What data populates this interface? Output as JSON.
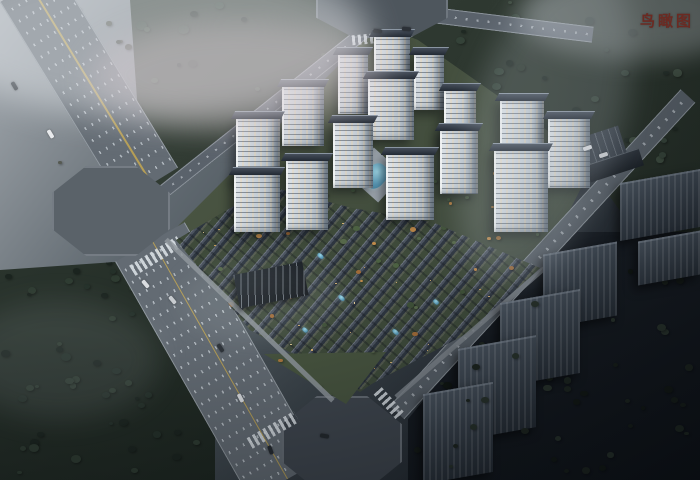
{
  "label": {
    "text": "鸟瞰图",
    "color": "#6b2a22"
  },
  "palette": {
    "fog_light": "#d8dce0",
    "ground_light": "#9aa2a8",
    "ground_dark": "#0d1116",
    "road_surface": "#5d656d",
    "lane_marking_white": "#e8eef3",
    "center_line_yellow": "#bfa452",
    "tower_facade": "#ccd4db",
    "tower_roof": "#2b323d",
    "lit_window_warm": "#ffd9a0",
    "villa_roof": "#39424e",
    "landscape_green": "#42503d",
    "autumn_tree_orange": "#b07c42",
    "forest_green_dark": "#27322a",
    "pool_water_blue": "#6fc0d8",
    "context_building_gray": "#3a434e",
    "label_red": "#6b2a22"
  },
  "scene": {
    "towers": [
      [
        338,
        52,
        30,
        62
      ],
      [
        374,
        34,
        36,
        64
      ],
      [
        414,
        52,
        30,
        58
      ],
      [
        282,
        84,
        42,
        62
      ],
      [
        368,
        76,
        46,
        64
      ],
      [
        444,
        88,
        32,
        60
      ],
      [
        236,
        116,
        44,
        66
      ],
      [
        333,
        120,
        40,
        68
      ],
      [
        440,
        128,
        38,
        66
      ],
      [
        500,
        98,
        44,
        68
      ],
      [
        234,
        172,
        46,
        60
      ],
      [
        286,
        158,
        42,
        72
      ],
      [
        386,
        152,
        48,
        68
      ],
      [
        548,
        116,
        42,
        72
      ],
      [
        494,
        148,
        54,
        84
      ]
    ],
    "dark_buildings": [
      [
        638,
        236,
        62,
        44
      ],
      [
        620,
        176,
        80,
        58
      ],
      [
        543,
        248,
        74,
        74
      ],
      [
        500,
        296,
        80,
        84
      ],
      [
        458,
        342,
        78,
        92
      ],
      [
        423,
        388,
        70,
        90
      ]
    ],
    "cars": [
      [
        46,
        132,
        59,
        "#e9ebed"
      ],
      [
        10,
        84,
        59,
        "#32383e"
      ],
      [
        141,
        282,
        50,
        "#dadde0"
      ],
      [
        168,
        298,
        50,
        "#c8ccd0"
      ],
      [
        216,
        346,
        57,
        "#2e343a"
      ],
      [
        236,
        396,
        62,
        "#d9dcdf"
      ],
      [
        320,
        434,
        10,
        "#23282d"
      ],
      [
        266,
        448,
        70,
        "#252a2f"
      ],
      [
        373,
        29,
        5,
        "#2c3137"
      ],
      [
        402,
        27,
        5,
        "#2c3137"
      ],
      [
        583,
        146,
        -18,
        "#dfe2e5"
      ],
      [
        599,
        153,
        -18,
        "#d3d6d9"
      ]
    ],
    "pools": [
      [
        366,
        163,
        20,
        26,
        42
      ],
      [
        317,
        254,
        7,
        4,
        42
      ],
      [
        338,
        296,
        7,
        4,
        42
      ],
      [
        302,
        328,
        6,
        4,
        42
      ],
      [
        392,
        330,
        7,
        4,
        42
      ],
      [
        433,
        300,
        6,
        4,
        42
      ]
    ],
    "scatter": [
      {
        "host": "#forest-top",
        "name": "forest-tree",
        "count": 110,
        "colors": [
          "#2a352c",
          "#344238",
          "#1f2923",
          "#3c4a3e"
        ],
        "min": 4,
        "max": 11,
        "seed": 7
      },
      {
        "host": "#forest-bl",
        "name": "forest-tree",
        "count": 55,
        "colors": [
          "#243029",
          "#2e3b31",
          "#1b241f"
        ],
        "min": 4,
        "max": 10,
        "seed": 11
      },
      {
        "host": "#forest-se",
        "name": "forest-tree",
        "count": 48,
        "colors": [
          "#161d18",
          "#1f2821",
          "#111713"
        ],
        "min": 4,
        "max": 10,
        "seed": 23
      },
      {
        "host": "#villa-zone",
        "name": "villa-tree",
        "count": 58,
        "colors": [
          "#3f5138",
          "#4c6142",
          "#a06b38",
          "#c08a4a",
          "#56684a"
        ],
        "min": 3,
        "max": 7,
        "seed": 31
      },
      {
        "host": "#villa-zone",
        "name": "window-light",
        "count": 42,
        "colors": [
          "#e8c078",
          "#f7dc9e",
          "#d9a95e"
        ],
        "min": 1,
        "max": 2,
        "seed": 41
      },
      {
        "host": "#tower-green",
        "name": "courtyard-tree",
        "count": 26,
        "colors": [
          "#45583f",
          "#52664a",
          "#b07c42",
          "#c9924e"
        ],
        "min": 3,
        "max": 6,
        "seed": 53
      },
      {
        "host": "#se-front-trees",
        "name": "dark-tree",
        "count": 20,
        "colors": [
          "#1c241e",
          "#27312a"
        ],
        "min": 4,
        "max": 9,
        "seed": 61
      },
      {
        "host": "#wedge-green",
        "name": "street-tree",
        "count": 9,
        "colors": [
          "#44543e",
          "#55664b",
          "#a9763f"
        ],
        "min": 3,
        "max": 6,
        "seed": 71
      },
      {
        "host": "#nw-field",
        "name": "field-tree",
        "count": 26,
        "colors": [
          "#4a4f48",
          "#3d443d",
          "#565a52"
        ],
        "min": 3,
        "max": 8,
        "seed": 83
      }
    ]
  }
}
